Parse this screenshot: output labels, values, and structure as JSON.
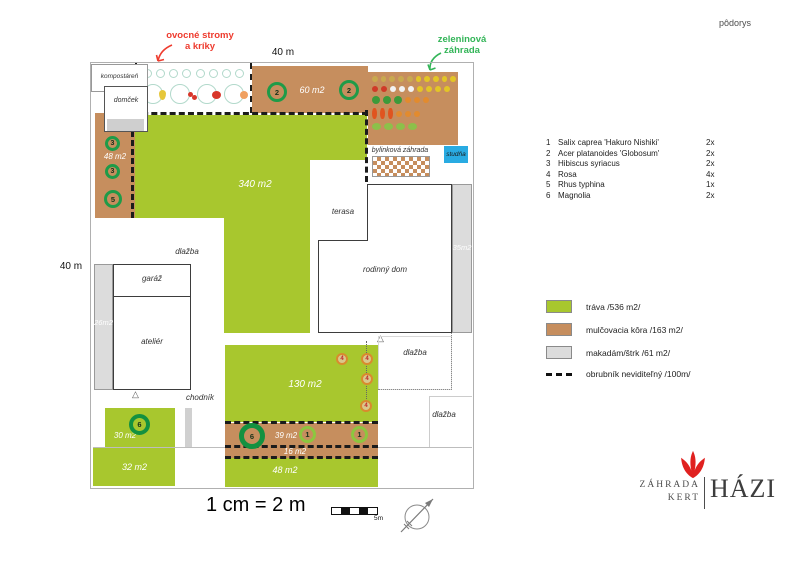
{
  "page": {
    "plan_type": "pôdorys"
  },
  "annotations": {
    "fruit_line1": "ovocné stromy",
    "fruit_line2": "a kríky",
    "veg_line1": "zeleninová",
    "veg_line2": "záhrada"
  },
  "dimensions": {
    "top": "40 m",
    "left": "40 m"
  },
  "plan": {
    "rooms": {
      "compost": "kompostáreň",
      "shed": "domček",
      "terrace": "terasa",
      "house": "rodinný dom",
      "garage": "garáž",
      "studio": "ateliér",
      "well": "studňa"
    },
    "labels": {
      "paving": "dlažba",
      "walkway": "chodník",
      "herb_garden": "bylinková záhrada"
    },
    "areas": {
      "mulch_top": "60 m2",
      "mulch_left": "48 m2",
      "lawn_main": "340 m2",
      "gravel_right": "35m2",
      "gravel_left": "26m2",
      "lawn_mid": "130 m2",
      "lawn_front_left": "30 m2",
      "lawn_street_left": "32 m2",
      "mulch_bed": "39 m2",
      "mulch_strip": "16 m2",
      "lawn_street": "48 m2"
    },
    "markers": {
      "n1": "1",
      "n2": "2",
      "n3": "3",
      "n4": "4",
      "n5": "5",
      "n6": "6"
    }
  },
  "plant_list": [
    {
      "num": "1",
      "name": "Salix caprea 'Hakuro Nishiki'",
      "qty": "2x"
    },
    {
      "num": "2",
      "name": "Acer platanoides 'Globosum'",
      "qty": "2x"
    },
    {
      "num": "3",
      "name": "Hibiscus syriacus",
      "qty": "2x"
    },
    {
      "num": "4",
      "name": "Rosa",
      "qty": "4x"
    },
    {
      "num": "5",
      "name": "Rhus typhina",
      "qty": "1x"
    },
    {
      "num": "6",
      "name": "Magnolia",
      "qty": "2x"
    }
  ],
  "legend": [
    {
      "label": "tráva /536 m2/",
      "swatch": "#a8c72e"
    },
    {
      "label": "mulčovacia kôra /163 m2/",
      "swatch": "#c68e5e"
    },
    {
      "label": "makadám/štrk /61 m2/",
      "swatch": "#dcdcdc"
    },
    {
      "label": "obrubník neviditeľný /100m/",
      "swatch": "dashed"
    }
  ],
  "scale": {
    "text": "1 cm = 2 m",
    "bar_label": "5m"
  },
  "logo": {
    "word1": "ZÁHRADA",
    "word2": "KERT",
    "word3": "HÁZI"
  },
  "colors": {
    "lawn": "#a8c72e",
    "mulch": "#c68e5e",
    "gravel": "#dcdcdc",
    "well_blue": "#29abe2",
    "marker_green": "#1f9b48",
    "annotation_red": "#ee3b2e",
    "annotation_green": "#33b558"
  }
}
